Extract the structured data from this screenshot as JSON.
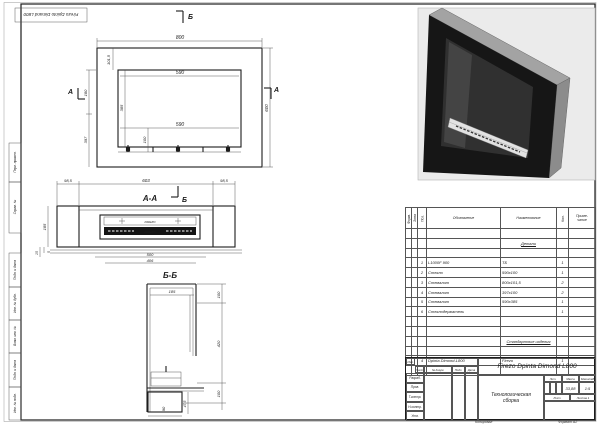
{
  "stamp": {
    "text": "Firezo Dpinto Dimand L800"
  },
  "margin": {
    "labels": [
      "Перв. примен.",
      "Справ. №",
      "Подп. и дата",
      "Инв. № дубл.",
      "Взам. инв. №",
      "Подп. и дата",
      "Инв. № подл."
    ]
  },
  "front_view": {
    "marks": {
      "b": "Б",
      "a": "А"
    },
    "dims": {
      "w_overall": "800",
      "offset_top": "101,5",
      "w_inner_top": "590",
      "w_inner_bottom": "590",
      "h_overall": "600",
      "h_opening": "385",
      "h_left_upper": "180",
      "h_left_lower": "397",
      "h_bottom": "100"
    }
  },
  "section_aa": {
    "label": "А-А",
    "mark_b": "Б",
    "burner_brand": "FIREZO",
    "dims": {
      "side_left": "98,5",
      "center": "603",
      "side_right": "98,5",
      "w_500": "500",
      "w_406": "406",
      "h_185": "185",
      "h_5": "5",
      "h_15": "15"
    }
  },
  "section_bb": {
    "label": "Б-Б",
    "dims": {
      "depth": "185",
      "h_top": "100",
      "h_mid": "420",
      "h_bottom": "100",
      "w_90": "90",
      "h_475": "47,5"
    }
  },
  "spec_table": {
    "headers": {
      "format": "Форм.",
      "zone": "Зона",
      "pos": "Поз.",
      "designation": "Обозначение",
      "name": "Наименование",
      "qty": "Кол.",
      "note": "Приме-\nчание"
    },
    "section1": "Детали",
    "rows": [
      {
        "pos": "1",
        "designation": "L1000F 900",
        "name": "ТБ",
        "qty": "1"
      },
      {
        "pos": "2",
        "designation": "Стекло",
        "name": "590х100",
        "qty": "1"
      },
      {
        "pos": "3",
        "designation": "Стемалит",
        "name": "800х101,5",
        "qty": "2"
      },
      {
        "pos": "4",
        "designation": "Стемалит",
        "name": "397х100",
        "qty": "2"
      },
      {
        "pos": "5",
        "designation": "Стемалит",
        "name": "590х385",
        "qty": "1"
      },
      {
        "pos": "6",
        "designation": "Стеклодержатель",
        "name": "",
        "qty": "1"
      }
    ],
    "section2": "Стандартные изделия",
    "rows2": [
      {
        "pos": "4",
        "designation": "Dpinta Dimond-L800",
        "name": "Firezo",
        "qty": "1"
      }
    ]
  },
  "title_block": {
    "doc_title": "Firezo Dpinta Dimond L800",
    "doc_subtitle": "Технологическая сборка",
    "rev_headers": [
      "Изм.",
      "Лист",
      "№ докум.",
      "Подп.",
      "Дата"
    ],
    "roles": [
      "Разраб.",
      "Пров.",
      "Т.контр.",
      "Н.контр.",
      "Утв."
    ],
    "lit_label": "Лит.",
    "mass_label": "Масса",
    "scale_label": "Масштаб",
    "mass": "33,88",
    "scale": "1:5",
    "sheet_label": "Лист",
    "sheets_label": "Листов",
    "sheets_value": "1",
    "copied_label": "Копировал",
    "format_label": "Формат",
    "format_value": "А2"
  }
}
